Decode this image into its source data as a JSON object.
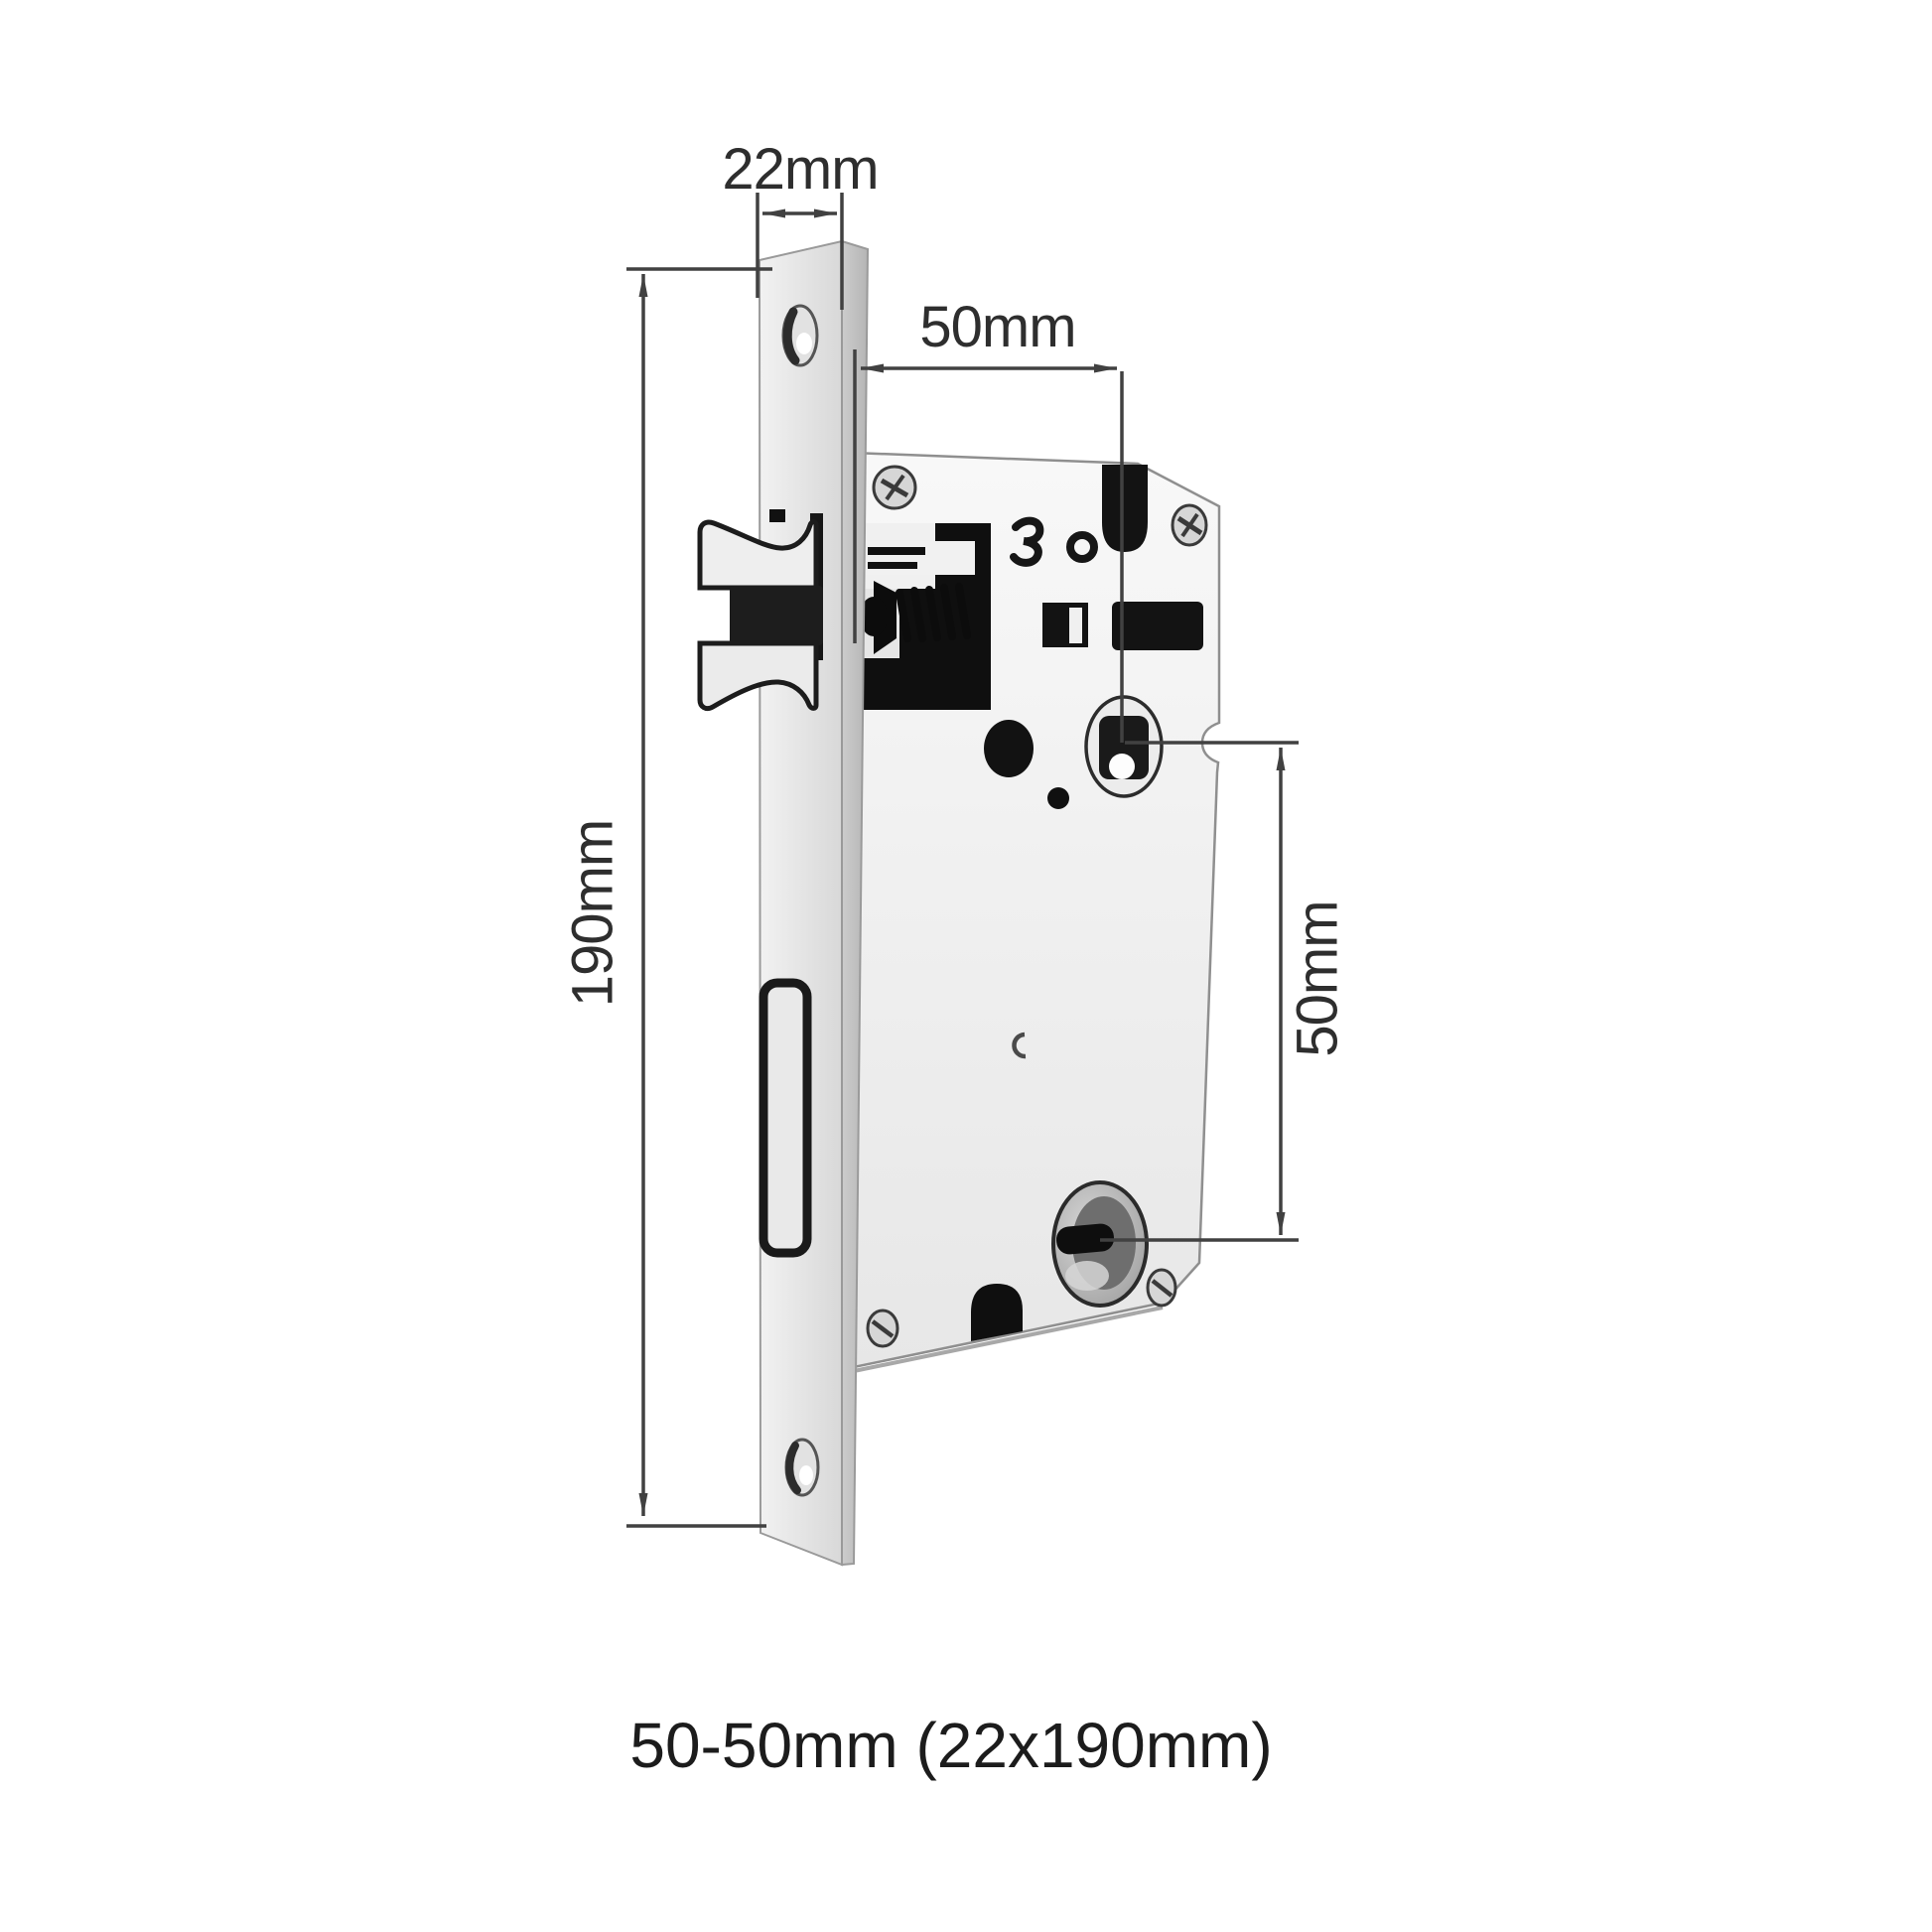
{
  "diagram": {
    "subject": "mortise-lock-dimension-diagram",
    "dimensions": {
      "faceplate_width": "22mm",
      "backset": "50mm",
      "faceplate_height": "190mm",
      "cylinder_to_hub_spacing": "50mm"
    },
    "caption": "50-50mm (22x190mm)",
    "colors": {
      "line": "#414141",
      "label_text": "#2e2e2e",
      "caption_text": "#1c1c1c",
      "metal_light": "#efefef",
      "metal_shadow": "#c6c6c6",
      "cutout_black": "#101010",
      "background": "#ffffff"
    }
  }
}
